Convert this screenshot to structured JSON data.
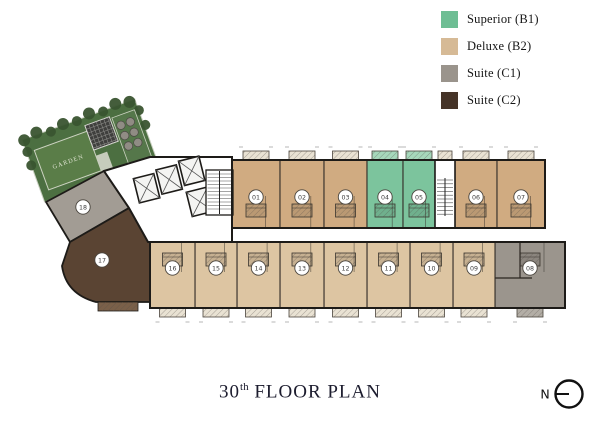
{
  "legend": {
    "items": [
      {
        "label": "Superior (B1)",
        "color": "#6ebe94"
      },
      {
        "label": "Deluxe (B2)",
        "color": "#d6ba96"
      },
      {
        "label": "Suite (C1)",
        "color": "#9a948c"
      },
      {
        "label": "Suite (C2)",
        "color": "#463428"
      }
    ]
  },
  "title": {
    "floor_number": "30",
    "ordinal_suffix": "th",
    "label": "FLOOR PLAN"
  },
  "compass": {
    "label": "N"
  },
  "garden": {
    "label": "GARDEN"
  },
  "units": [
    {
      "number": "01",
      "type": "Deluxe (B2)",
      "color": "#d0ab81"
    },
    {
      "number": "02",
      "type": "Deluxe (B2)",
      "color": "#d0ab81"
    },
    {
      "number": "03",
      "type": "Deluxe (B2)",
      "color": "#d0ab81"
    },
    {
      "number": "04",
      "type": "Superior (B1)",
      "color": "#7cc49d"
    },
    {
      "number": "05",
      "type": "Superior (B1)",
      "color": "#7cc49d"
    },
    {
      "number": "06",
      "type": "Deluxe (B2)",
      "color": "#d0ab81"
    },
    {
      "number": "07",
      "type": "Deluxe (B2)",
      "color": "#d0ab81"
    },
    {
      "number": "08",
      "type": "Suite (C1)",
      "color": "#9b958d"
    },
    {
      "number": "09",
      "type": "Deluxe (B2)",
      "color": "#ddc5a2"
    },
    {
      "number": "10",
      "type": "Deluxe (B2)",
      "color": "#ddc5a2"
    },
    {
      "number": "11",
      "type": "Deluxe (B2)",
      "color": "#ddc5a2"
    },
    {
      "number": "12",
      "type": "Deluxe (B2)",
      "color": "#ddc5a2"
    },
    {
      "number": "13",
      "type": "Deluxe (B2)",
      "color": "#ddc5a2"
    },
    {
      "number": "14",
      "type": "Deluxe (B2)",
      "color": "#ddc5a2"
    },
    {
      "number": "15",
      "type": "Deluxe (B2)",
      "color": "#ddc5a2"
    },
    {
      "number": "16",
      "type": "Deluxe (B2)",
      "color": "#ddc5a2"
    },
    {
      "number": "17",
      "type": "Suite (C2)",
      "color": "#5a4433"
    },
    {
      "number": "18",
      "type": "Suite (C1)",
      "color": "#a29c94"
    }
  ]
}
